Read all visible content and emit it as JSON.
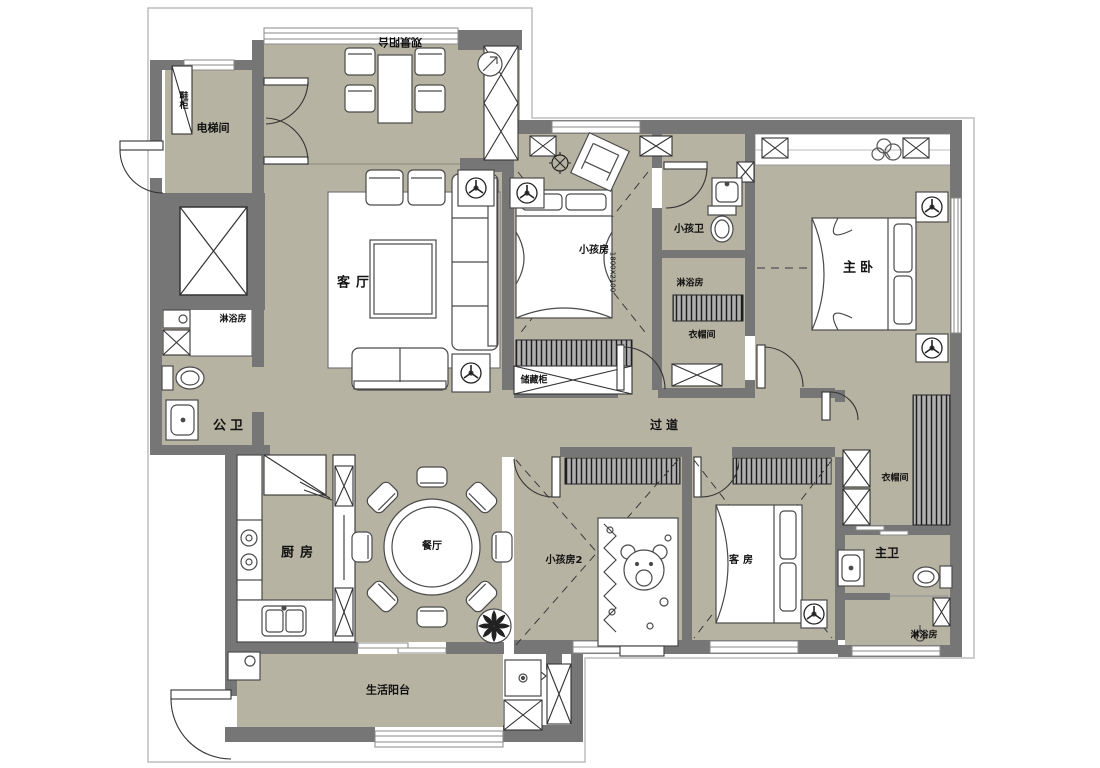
{
  "labels": {
    "view_balcony": "观景阳台",
    "shoe_cabinet": "鞋柜",
    "elevator_hall": "电梯间",
    "shower_public": "淋浴房",
    "public_bath": "公卫",
    "living_room": "客厅",
    "kitchen": "厨房",
    "dining_room": "餐厅",
    "service_balcony": "生活阳台",
    "kids_room_1": "小孩房",
    "kids_bed_dim": "1800X2100",
    "kids_bath": "小孩卫",
    "shower_mid": "淋浴房",
    "closet_mid": "衣帽间",
    "storage_cabinet": "储藏柜",
    "hallway": "过道",
    "master_bedroom": "主卧",
    "kids_room_2": "小孩房2",
    "guest_room": "客房",
    "master_closet": "衣帽间",
    "master_bath": "主卫",
    "shower_master": "淋浴房"
  },
  "colors": {
    "floor": "#b7b3a2",
    "wall": "#767676",
    "line": "#4a4a4a",
    "paper": "#ffffff"
  }
}
